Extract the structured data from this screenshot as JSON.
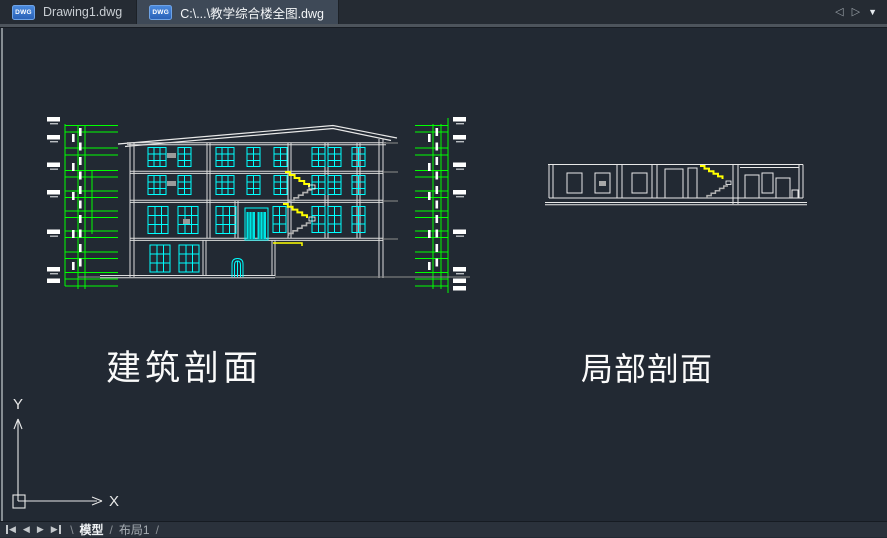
{
  "app": {
    "file_tabs": [
      {
        "label": "Drawing1.dwg",
        "active": false
      },
      {
        "label": "C:\\...\\教学综合楼全图.dwg",
        "active": true
      }
    ],
    "tab_icon_label": "DWG",
    "tab_nav": {
      "prev_glyph": "◁",
      "next_glyph": "▷",
      "menu_glyph": "▼"
    }
  },
  "canvas": {
    "left_drawing_label": "建筑剖面",
    "right_drawing_label": "局部剖面",
    "ucs": {
      "x_label": "X",
      "y_label": "Y"
    }
  },
  "statusbar": {
    "nav_icons": {
      "first_glyph": "◀",
      "prev_glyph": "◀",
      "next_glyph": "▶",
      "last_glyph": "▶"
    },
    "sep_open": "\\",
    "sep_mid": "/",
    "sep_close": "/",
    "layout_tabs": [
      {
        "label": "模型",
        "active": true
      },
      {
        "label": "布局1",
        "active": false
      }
    ]
  },
  "colors": {
    "cad_green": "#00ff00",
    "cad_cyan": "#00ffff",
    "cad_yellow": "#ffff00",
    "dwg_icon_blue": "#2f72cc",
    "canvas_bg": "#222933"
  }
}
